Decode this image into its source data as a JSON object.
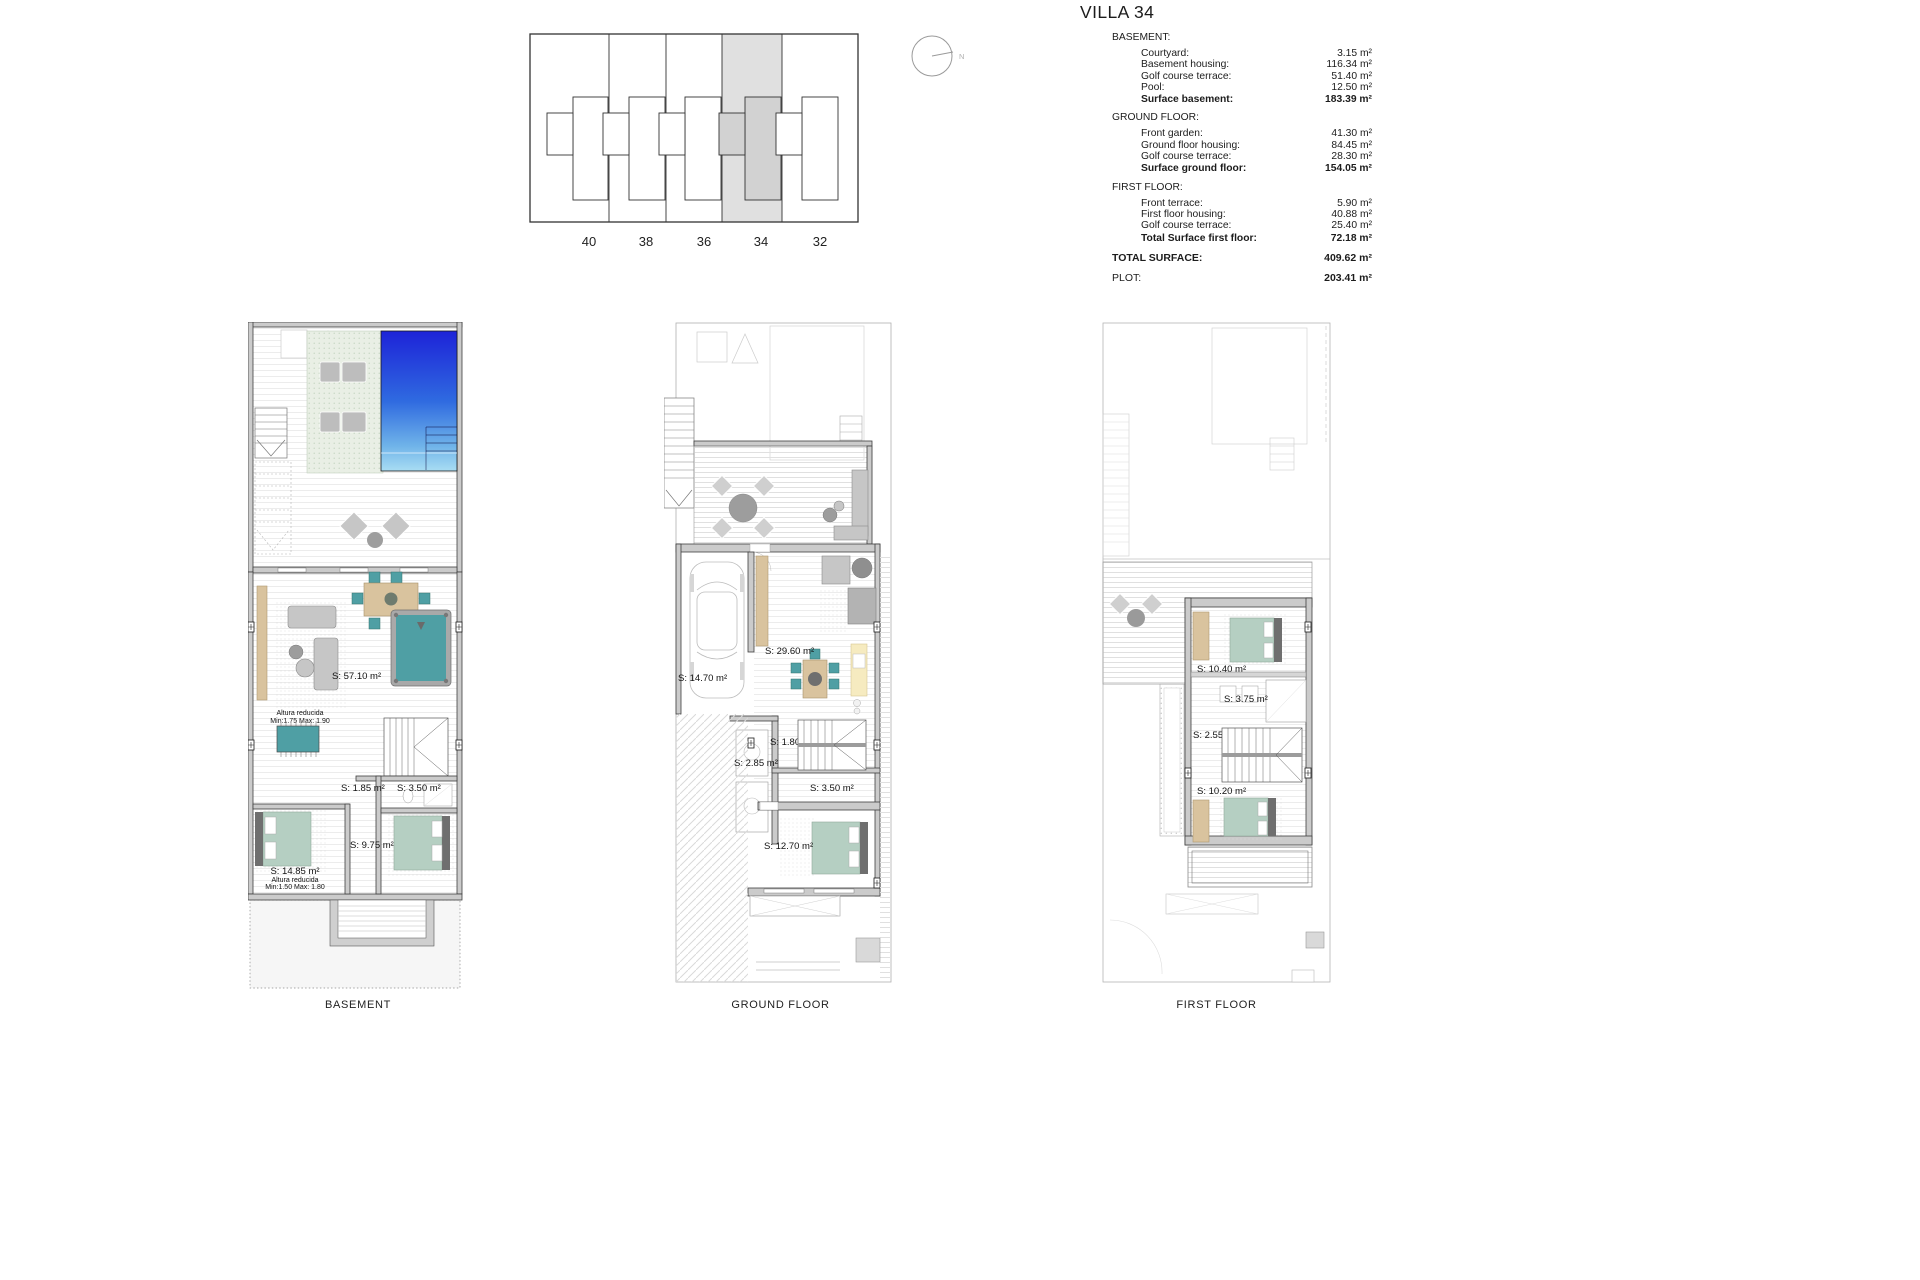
{
  "header": {
    "title": "VILLA 34",
    "sections": [
      {
        "name": "BASEMENT:",
        "rows": [
          {
            "label": "Courtyard:",
            "value": "3.15 m²"
          },
          {
            "label": "Basement housing:",
            "value": "116.34 m²"
          },
          {
            "label": "Golf course terrace:",
            "value": "51.40 m²"
          },
          {
            "label": "Pool:",
            "value": "12.50 m²"
          }
        ],
        "total": {
          "label": "Surface basement:",
          "value": "183.39 m²"
        }
      },
      {
        "name": "GROUND FLOOR:",
        "rows": [
          {
            "label": "Front garden:",
            "value": "41.30 m²"
          },
          {
            "label": "Ground floor housing:",
            "value": "84.45 m²"
          },
          {
            "label": "Golf course terrace:",
            "value": "28.30 m²"
          }
        ],
        "total": {
          "label": "Surface ground floor:",
          "value": "154.05 m²"
        }
      },
      {
        "name": "FIRST FLOOR:",
        "rows": [
          {
            "label": "Front terrace:",
            "value": "5.90 m²"
          },
          {
            "label": "First floor housing:",
            "value": "40.88 m²"
          },
          {
            "label": "Golf course terrace:",
            "value": "25.40 m²"
          }
        ],
        "total": {
          "label": "Total Surface first floor:",
          "value": "72.18 m²"
        }
      }
    ],
    "summary": [
      {
        "label": "TOTAL SURFACE:",
        "value": "409.62 m²"
      },
      {
        "label": "PLOT:",
        "value": "203.41 m²"
      }
    ]
  },
  "site_plan": {
    "units": [
      "40",
      "38",
      "36",
      "34",
      "32"
    ],
    "highlighted_unit": "34",
    "compass_label": "N"
  },
  "plans": {
    "basement": {
      "caption": "BASEMENT",
      "labels": {
        "living": "S: 57.10 m²",
        "altura_living_1": "Altura reducida",
        "altura_living_2": "Min:1.75 Max: 1.90",
        "store_a": "S: 1.85 m²",
        "store_b": "S: 3.50 m²",
        "corridor": "S: 9.75 m²",
        "bedroom": "S: 14.85 m²",
        "altura_bed_1": "Altura reducida",
        "altura_bed_2": "Min:1.50 Max: 1.80"
      }
    },
    "ground": {
      "caption": "GROUND FLOOR",
      "labels": {
        "garage": "S: 14.70 m²",
        "living": "S: 29.60 m²",
        "wc": "S: 1.80 m²",
        "hall": "S: 2.85 m²",
        "store": "S: 3.50 m²",
        "bedroom": "S: 12.70 m²"
      }
    },
    "first": {
      "caption": "FIRST FLOOR",
      "labels": {
        "bedroom1": "S: 10.40 m²",
        "bathroom": "S: 3.75 m²",
        "landing": "S: 2.55 m²",
        "bedroom2": "S: 10.20 m²"
      }
    }
  },
  "colors": {
    "pool_deep": "#1d23d8",
    "pool_mid": "#2f6ae0",
    "pool_soft": "#6fb3e9",
    "pool_light": "#a9ddf3",
    "teal": "#4f9fa4",
    "bed_green": "#b5cfc2",
    "wood_tan": "#d9c39e",
    "highlight_gray": "#e0e0e0",
    "highlight_dark": "#d2d2d2"
  }
}
